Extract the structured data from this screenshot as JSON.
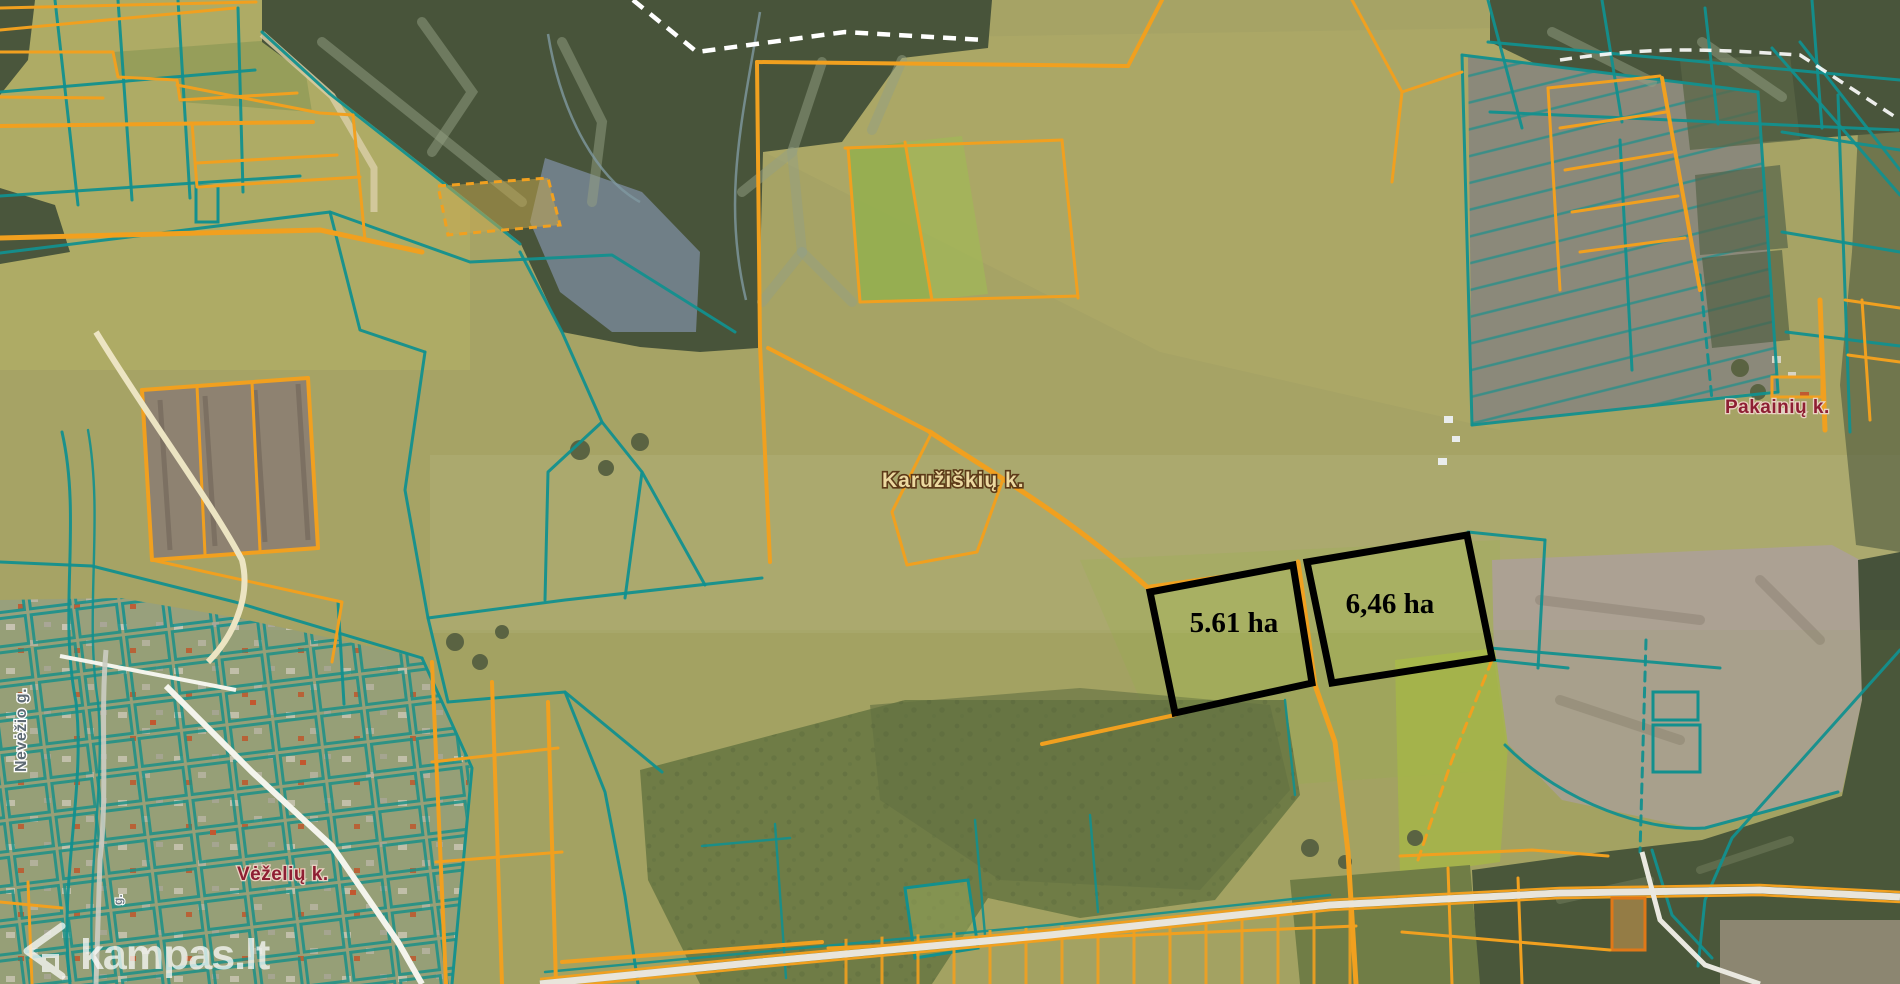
{
  "watermark": {
    "text": "kampas.lt",
    "icon": "house-chevron-icon"
  },
  "parcels": {
    "p1": {
      "area_label": "5.61 ha",
      "points": "1150,592 1293,565 1312,683 1175,713",
      "label_x": 1234,
      "label_y": 632
    },
    "p2": {
      "area_label": "6,46 ha",
      "points": "1307,562 1467,535 1492,658 1332,683",
      "label_x": 1390,
      "label_y": 613
    }
  },
  "labels": {
    "village_center": "Karužiškių k.",
    "village_right": "Pakainių k.",
    "village_bottom_left": "Vėželių k.",
    "street_left_vertical": "Nevėžio g.",
    "street_small_vertical": "g."
  },
  "map_colors": {
    "cadastral_line_teal": "#12908e",
    "cadastral_line_orange": "#f1a01f",
    "highlight_outline": "#000000",
    "village_label_light": "#ecd9a0",
    "village_label_dark": "#8e1f33",
    "watermark": "#ffffff"
  }
}
